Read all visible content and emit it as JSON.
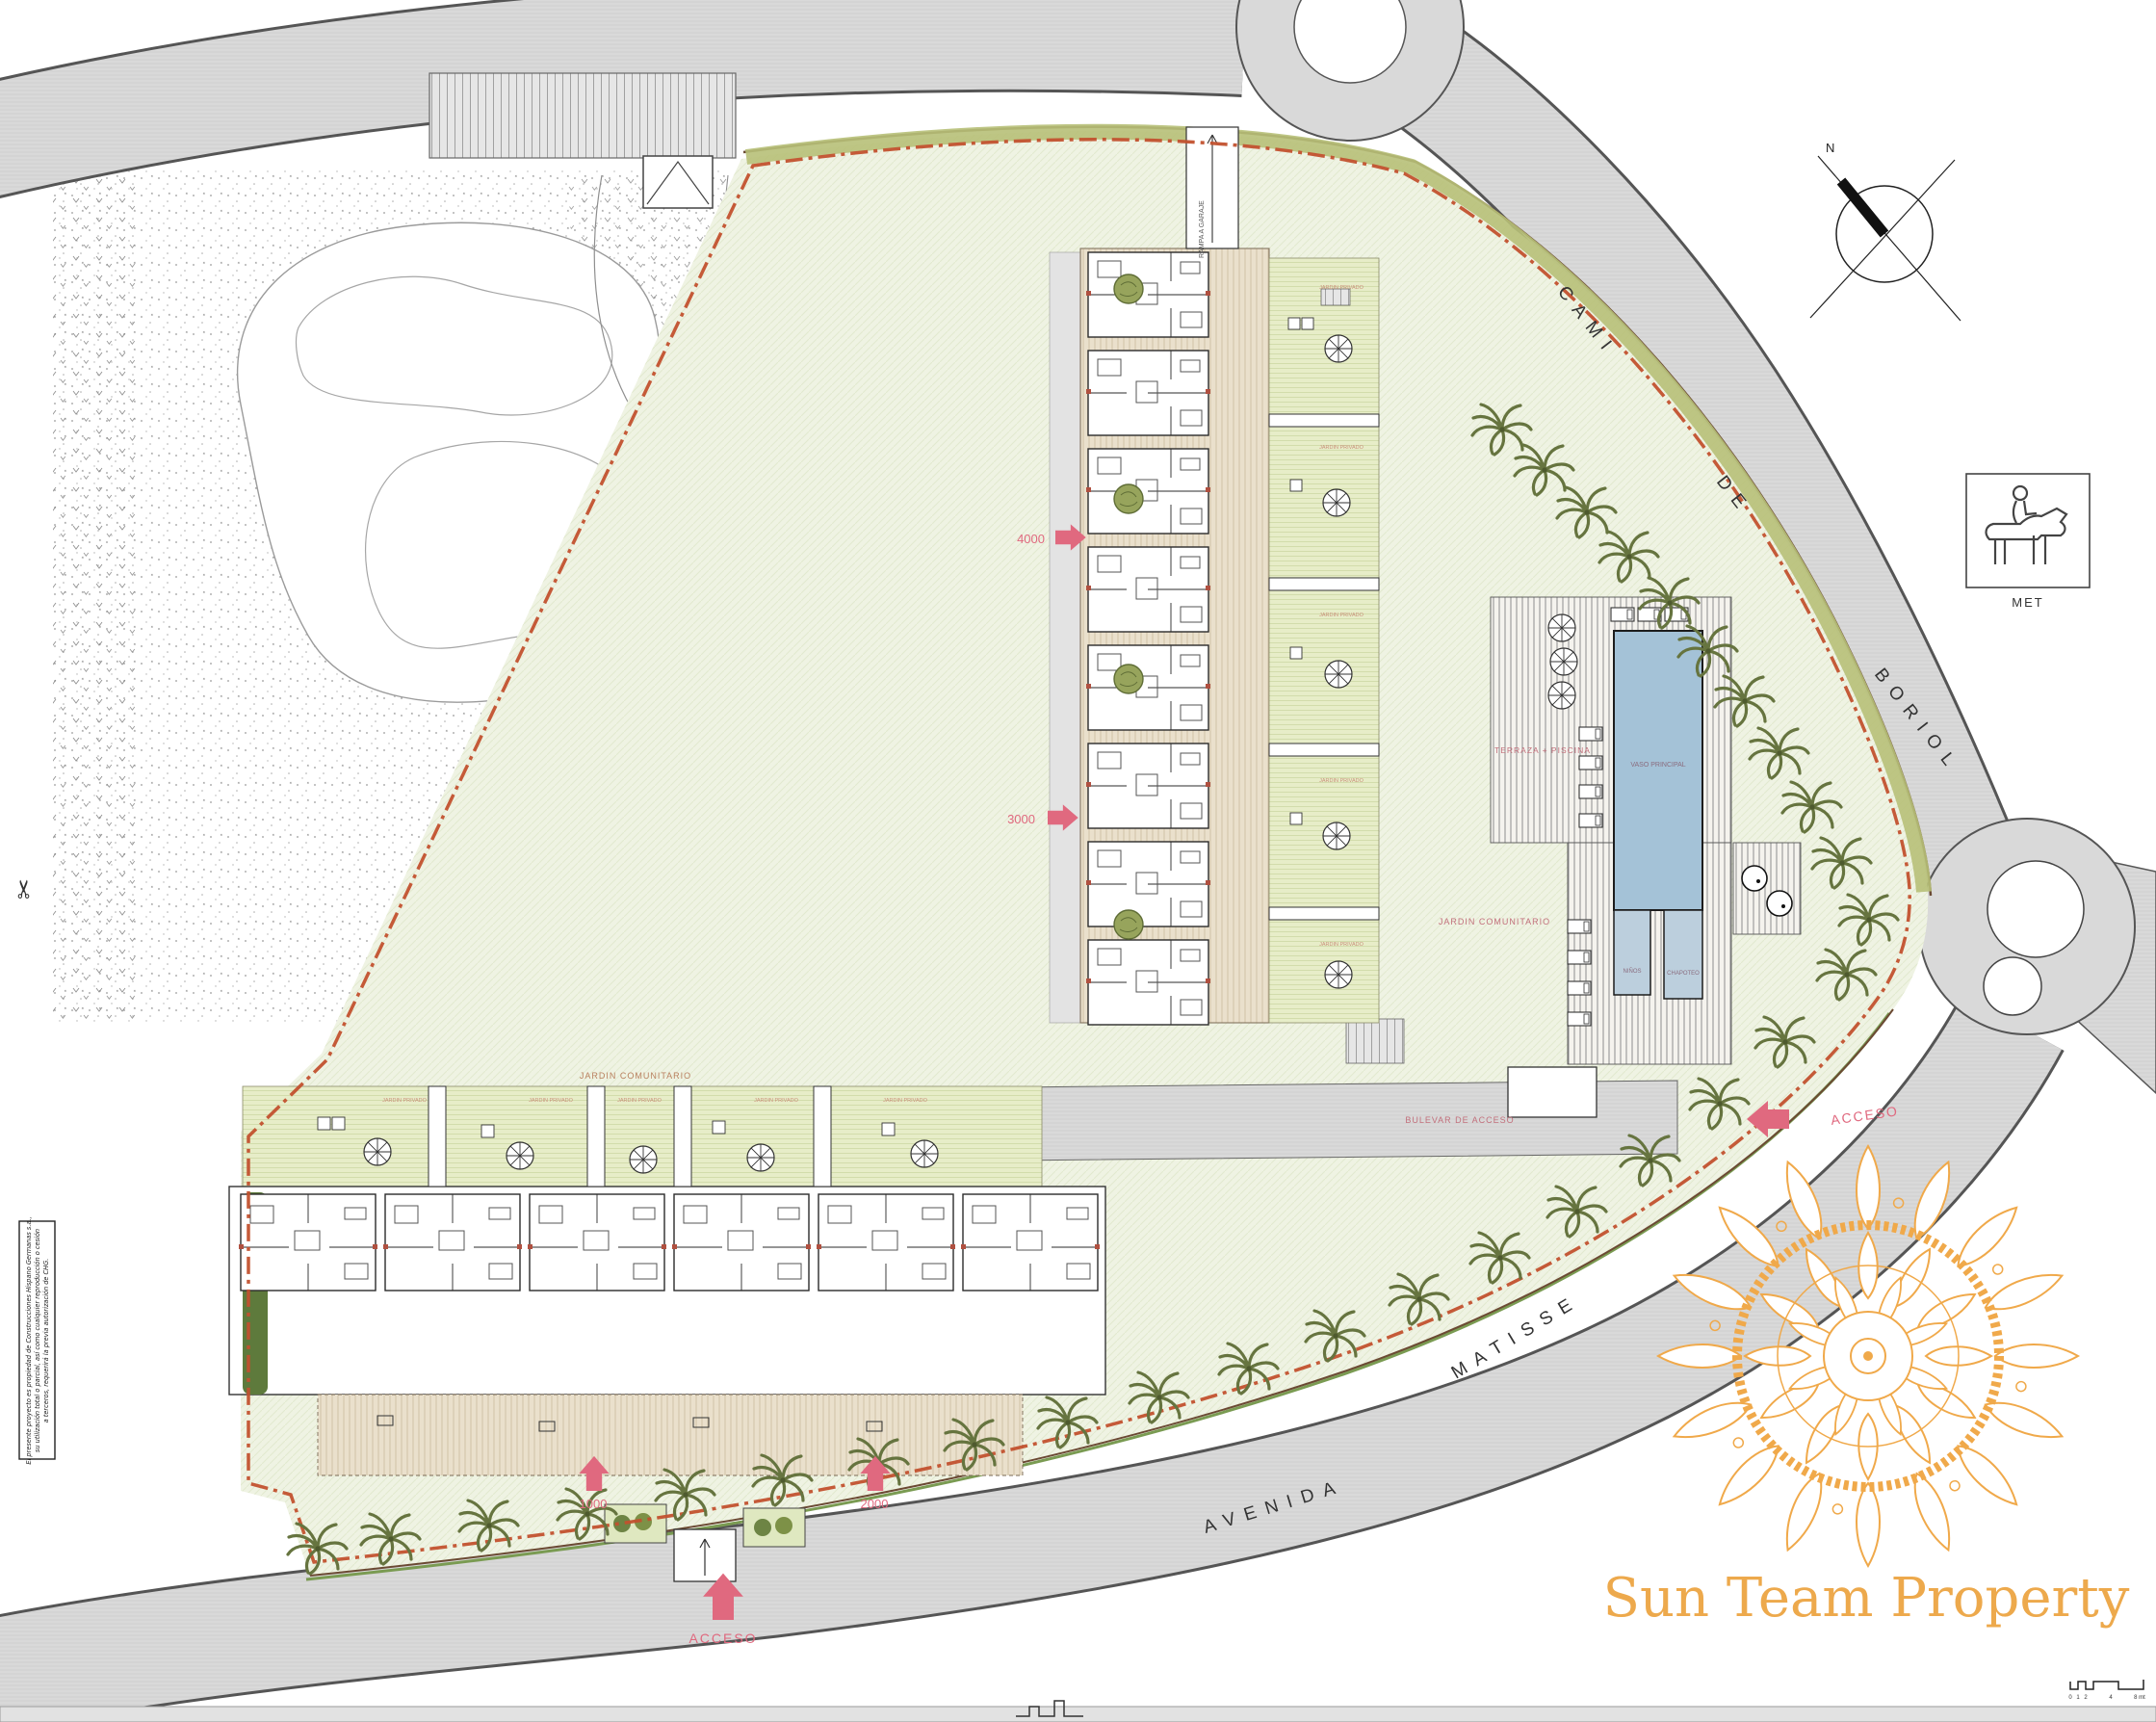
{
  "plan": {
    "golf": {
      "title_line1": "CAMPO DE GOLF",
      "title_line2": "DESIGN SEVE BALLESTEROS"
    },
    "streets": {
      "cami": [
        "CAMI",
        "DE",
        "BORIOL"
      ],
      "avenida": "AVENIDA",
      "matisse": "MATISSE",
      "bulevar": "BULEVAR DE ACCESO"
    },
    "access": {
      "right": "ACCESO",
      "bottom": "ACCESO"
    },
    "dimensions": {
      "d1000": "1000",
      "d2000": "2000",
      "d3000": "3000",
      "d4000": "4000"
    },
    "areas": {
      "jardin_comunitario": "JARDIN COMUNITARIO",
      "jardin_comunitario_2": "JARDIN COMUNITARIO",
      "jardin_privado": "JARDIN PRIVADO",
      "terraza_piscina": "TERRAZA + PISCINA",
      "vaso_principal": "VASO PRINCIPAL",
      "ninos": "NIÑOS",
      "chapoteo": "CHAPOTEO",
      "rampa": "RAMPA A GARAJE"
    },
    "signs": {
      "met": "MET",
      "north": "N"
    },
    "scale_bar": {
      "ticks": [
        "0",
        "1",
        "2",
        "4",
        "8 mt"
      ]
    },
    "copyright": {
      "lines": [
        "El presente proyecto es propiedad de Construcciones Hispano Germanas s.a.,",
        "su utilización total o parcial, así como cualquier reproducción o cesión",
        "a terceros, requerirá la previa autorización de CHG."
      ]
    }
  },
  "logo": {
    "name": "Sun Team Property"
  },
  "colors": {
    "logo_gold": "#f0a94a",
    "accent_pink": "#e0697f",
    "label_pink": "#c2707c",
    "boundary_red": "#c2512e",
    "pool_blue": "#a4c2d7",
    "kids_pool_blue": "#bccfdd",
    "road_gray": "#d9d9d9",
    "lawn_green": "#eff3e3",
    "garden_green": "#e7edc8",
    "deck_tan": "#eae0cc",
    "palm_green": "#66743f",
    "hedge_green": "#5e7a3c"
  }
}
